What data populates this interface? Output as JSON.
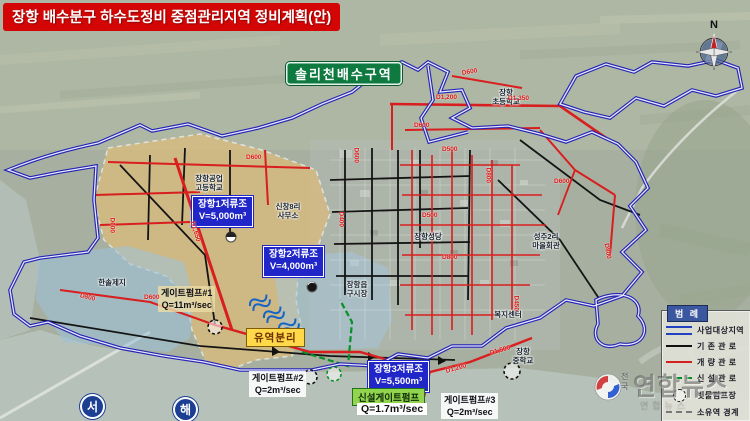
{
  "title": "장항 배수분구 하수도정비 중점관리지역 정비계획(안)",
  "region_badge": "솔리천배수구역",
  "compass_label": "N",
  "sea_labels": {
    "west": "서",
    "sea": "해"
  },
  "facilities": {
    "tank1": {
      "text": "장항1저류조\nV=5,000m³"
    },
    "tank2": {
      "text": "장항2저류조\nV=4,000m³"
    },
    "tank3": {
      "text": "장항3저류조\nV=5,500m³"
    },
    "pump1": {
      "text": "게이트펌프#1\nQ=11m³/sec"
    },
    "pump2": {
      "text": "게이트펌프#2\nQ=2m³/sec"
    },
    "pump3": {
      "text": "게이트펌프#3\nQ=2m³/sec"
    },
    "new_pump_name": "신설게이트펌프",
    "new_pump_q": "Q=1.7m³/sec",
    "flow_split": "유역분리"
  },
  "places": [
    {
      "text": "장항공업\n고등학교"
    },
    {
      "text": "신창8리\n사무소"
    },
    {
      "text": "한솔제지"
    },
    {
      "text": "장항\n초등학교"
    },
    {
      "text": "장항성당"
    },
    {
      "text": "성주2리\n마을회관"
    },
    {
      "text": "장항읍\n구시장"
    },
    {
      "text": "복지센터"
    },
    {
      "text": "장항\n중학교"
    }
  ],
  "pipe_labels": [
    {
      "text": "D1,200"
    },
    {
      "text": "D1,350"
    },
    {
      "text": "D600"
    },
    {
      "text": "D600"
    },
    {
      "text": "D500"
    },
    {
      "text": "D800"
    },
    {
      "text": "D600"
    },
    {
      "text": "D400"
    },
    {
      "text": "D500"
    },
    {
      "text": "D800"
    },
    {
      "text": "D600"
    },
    {
      "text": "D1,650"
    },
    {
      "text": "D600"
    },
    {
      "text": "D600"
    },
    {
      "text": "D800"
    },
    {
      "text": "D1,200"
    },
    {
      "text": "D1,500"
    },
    {
      "text": "D800"
    },
    {
      "text": "D600"
    },
    {
      "text": "D450"
    }
  ],
  "legend": {
    "title": "범 례",
    "items": [
      {
        "symbol": "project-area-double-blue-line",
        "label": "사업대상지역"
      },
      {
        "symbol": "existing-pipe-black-line",
        "label": "기 존 관 로"
      },
      {
        "symbol": "improved-pipe-red-line",
        "label": "개 량 관 로"
      },
      {
        "symbol": "new-pipe-green-dashed-line",
        "label": "신 설 관 로"
      },
      {
        "symbol": "rain-pump-dashed-circle",
        "label": "빗물펌프장"
      },
      {
        "symbol": "subbasin-gray-dashed-line",
        "label": "소유역 경계"
      }
    ]
  },
  "watermark": {
    "brand": "연합뉴스",
    "prefix": "전\n국",
    "sub": "연합뉴스"
  },
  "colors": {
    "title_bg": "#d40505",
    "badge_bg": "#0f7a40",
    "tank_label_bg": "#2026c8",
    "project_boundary": "#2424b4",
    "existing_pipe": "#141414",
    "improved_pipe": "#d81e1e",
    "new_pipe": "#089028",
    "basin_fill": "#e6bd74",
    "industrial_fill": "#9cc2dc",
    "flow_split_bg": "#ffd94a"
  }
}
